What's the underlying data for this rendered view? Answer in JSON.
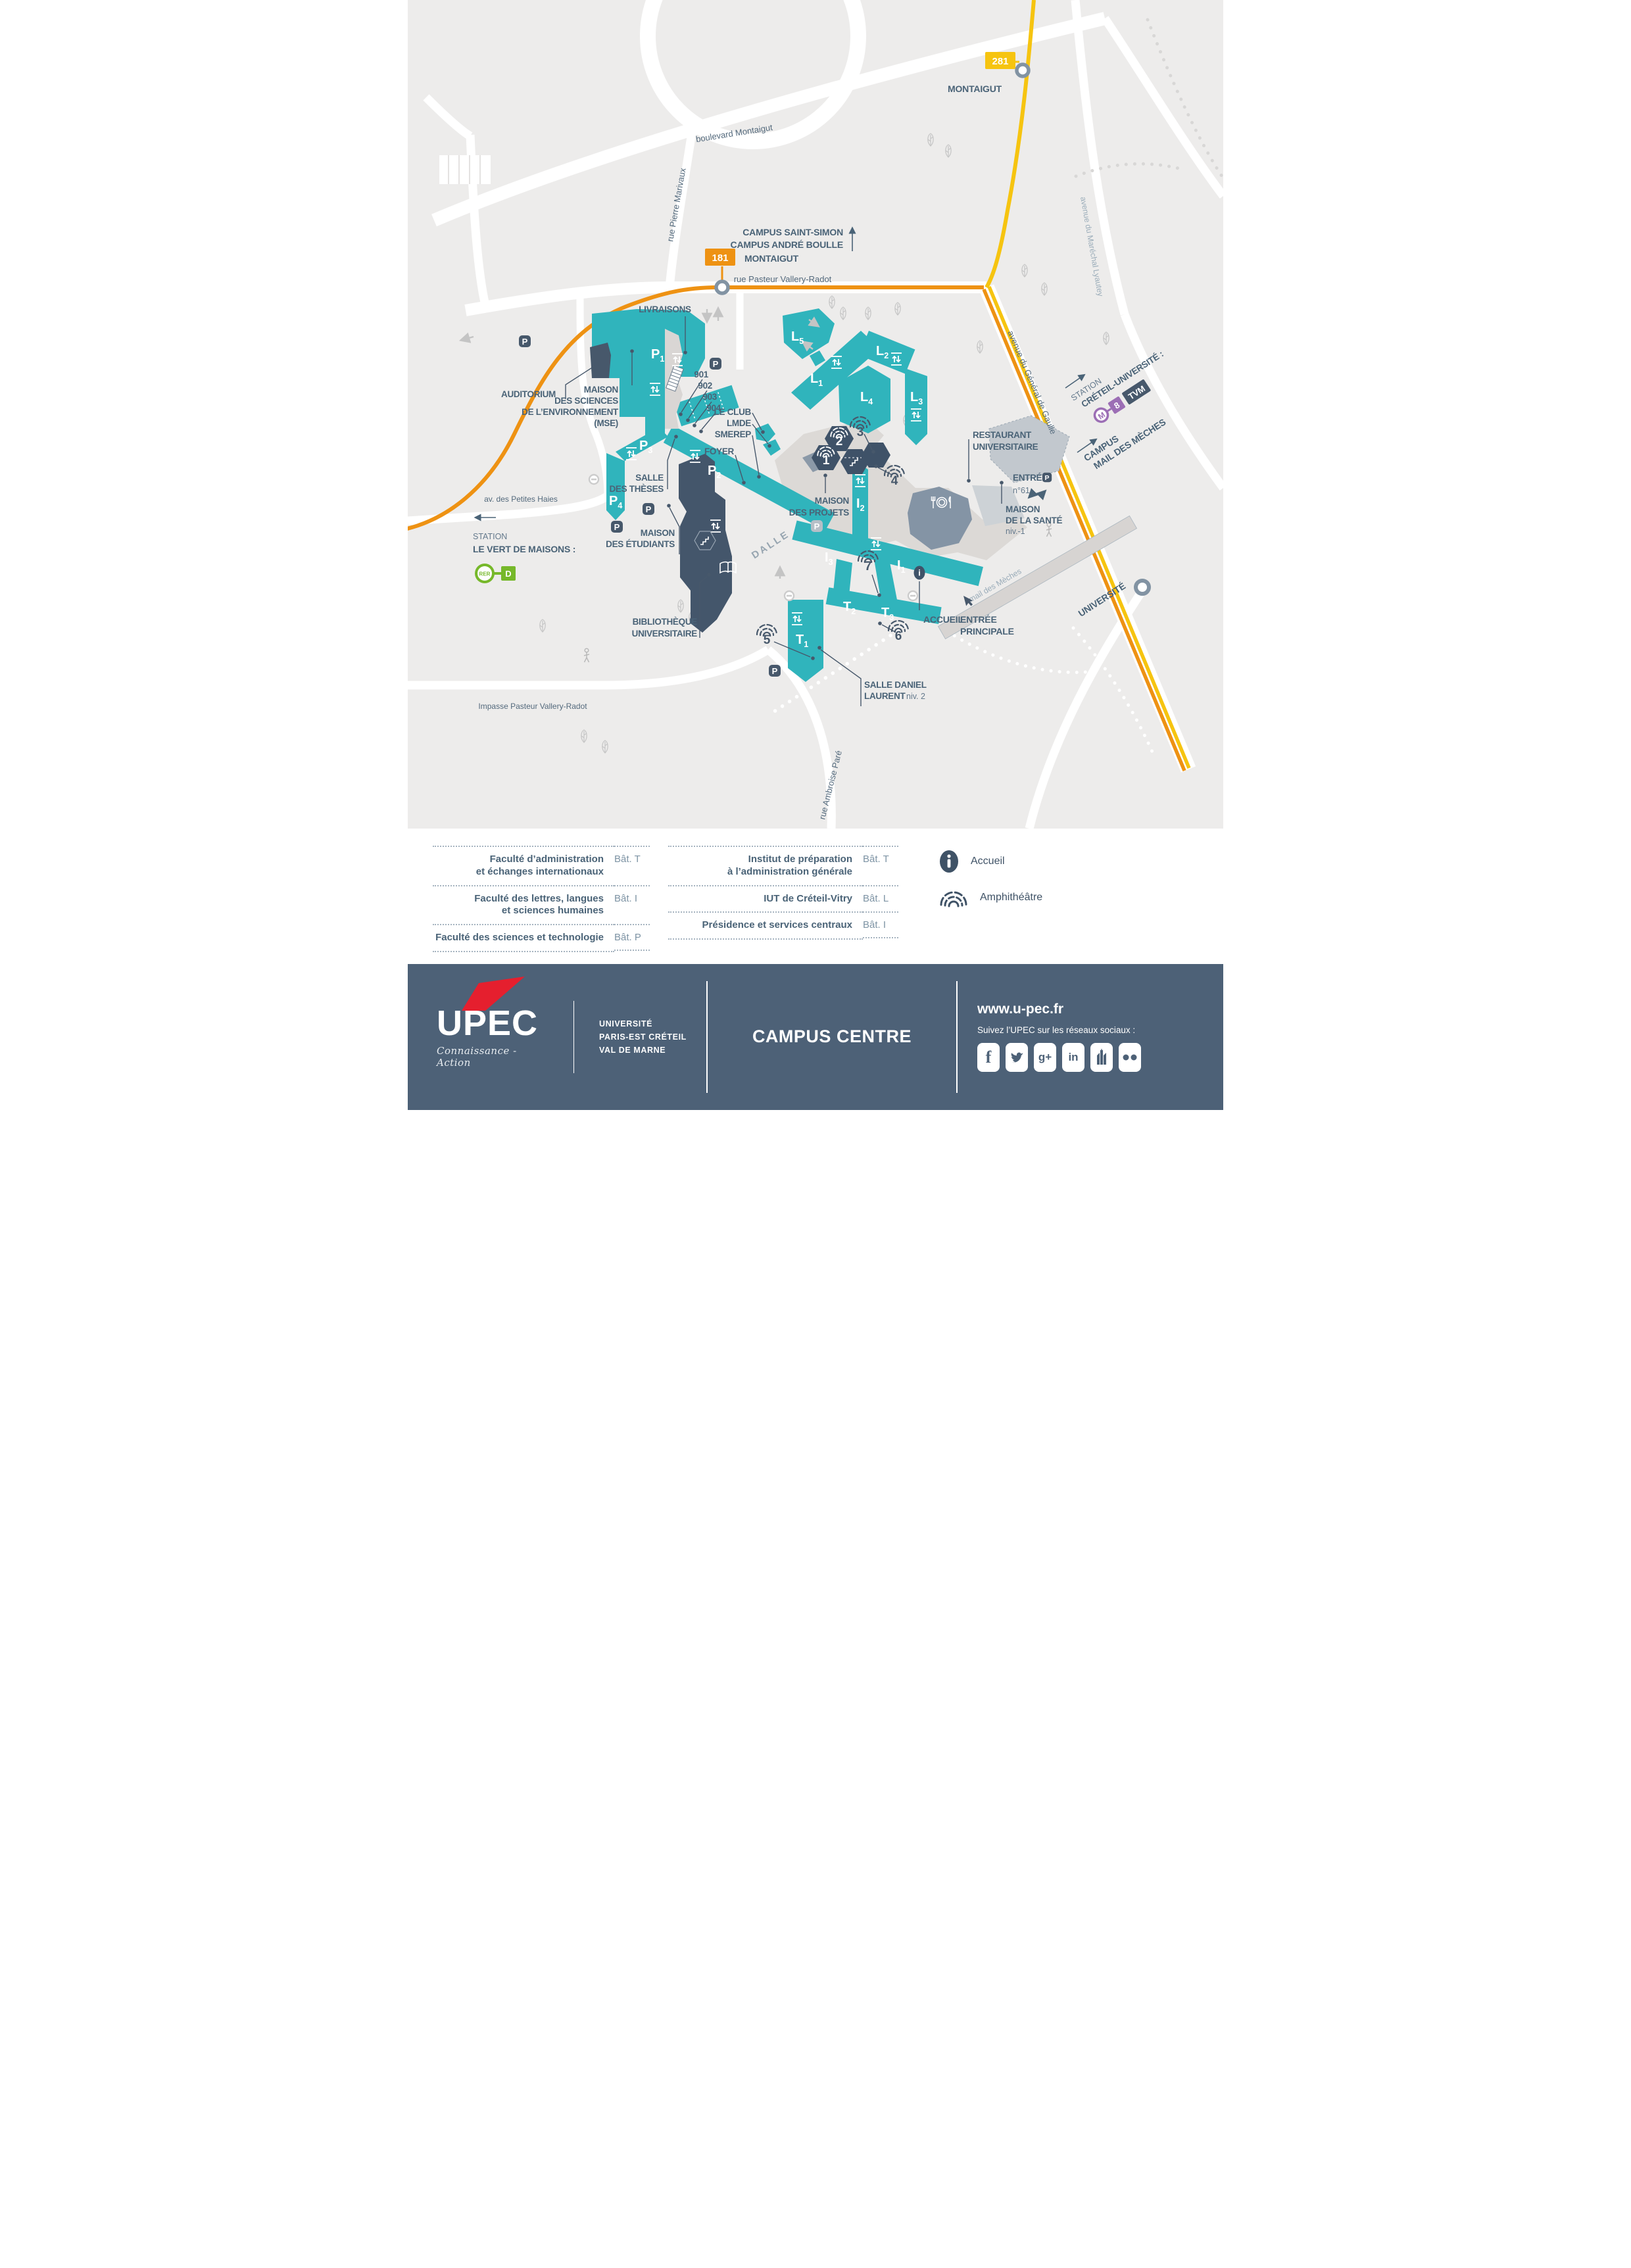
{
  "icons": {
    "parking": "P",
    "info": "i",
    "metro": "M",
    "metro_line": "8",
    "tvm": "TVM",
    "rer": "RER",
    "rer_line": "D"
  },
  "bus": {
    "line_281": "281",
    "line_181": "181",
    "montaigut": "MONTAIGUT",
    "universite": "UNIVERSITÉ"
  },
  "streets": {
    "boulevard_montaigut": "boulevard Montaigut",
    "rue_pierre_marivaux": "rue Pierre Marivaux",
    "rue_pasteur": "rue Pasteur Vallery-Radot",
    "impasse_pasteur": "Impasse Pasteur Vallery-Radot",
    "av_petites_haies": "av. des Petites Haies",
    "av_lyautey": "avenue du Maréchal Lyautey",
    "av_gaulle": "avenue du Général de Gaulle",
    "rue_ambroise_pare": "rue Ambroise Paré",
    "mail_des_meches": "mail des Mèches",
    "dalle": "DALLE"
  },
  "wayfinding": {
    "campus_saint_simon": "CAMPUS SAINT-SIMON",
    "campus_andre_boulle": "CAMPUS ANDRÉ BOULLE",
    "station": "STATION",
    "creteil_universite": "CRÉTEIL-UNIVERSITÉ :",
    "campus": "CAMPUS",
    "mail_des_meches": "MAIL DES MÈCHES",
    "le_vert_de_maisons": "LE VERT DE MAISONS :",
    "entree": "ENTRÉE",
    "n61": "n°61",
    "accueil": "ACCUEIL",
    "entree_principale_1": "ENTRÉE",
    "entree_principale_2": "PRINCIPALE"
  },
  "places": {
    "livraisons": "LIVRAISONS",
    "auditorium": "AUDITORIUM",
    "mse_1": "MAISON",
    "mse_2": "DES SCIENCES",
    "mse_3": "DE L’ENVIRONNEMENT",
    "mse_4": "(MSE)",
    "le_club": "LE CLUB",
    "lmde": "LMDE",
    "smerep": "SMEREP",
    "foyer": "FOYER",
    "salle_theses_1": "SALLE",
    "salle_theses_2": "DES THÈSES",
    "maison_etudiants_1": "MAISON",
    "maison_etudiants_2": "DES ÉTUDIANTS",
    "maison_projets_1": "MAISON",
    "maison_projets_2": "DES PROJETS",
    "restaurant_1": "RESTAURANT",
    "restaurant_2": "UNIVERSITAIRE",
    "maison_sante_1": "MAISON",
    "maison_sante_2": "DE LA SANTÉ",
    "maison_sante_niv": "niv.-1",
    "bibliotheque_1": "BIBLIOTHÈQUE",
    "bibliotheque_2": "UNIVERSITAIRE",
    "salle_daniel_1": "SALLE DANIEL",
    "salle_daniel_2": "LAURENT",
    "salle_daniel_niv": "niv. 2",
    "r901": "901",
    "r902": "902",
    "r903": "903",
    "r904": "904"
  },
  "buildings": {
    "p1": {
      "b": "P",
      "s": "1"
    },
    "p2": {
      "b": "P",
      "s": "2"
    },
    "p3": {
      "b": "P",
      "s": "3"
    },
    "p4": {
      "b": "P",
      "s": "4"
    },
    "l1": {
      "b": "L",
      "s": "1"
    },
    "l2": {
      "b": "L",
      "s": "2"
    },
    "l3": {
      "b": "L",
      "s": "3"
    },
    "l4": {
      "b": "L",
      "s": "4"
    },
    "l5": {
      "b": "L",
      "s": "5"
    },
    "i1": {
      "b": "I",
      "s": "1"
    },
    "i2": {
      "b": "I",
      "s": "2"
    },
    "i3": {
      "b": "I",
      "s": "3"
    },
    "t1": {
      "b": "T",
      "s": "1"
    },
    "t2": {
      "b": "T",
      "s": "2"
    },
    "t3": {
      "b": "T",
      "s": "3"
    }
  },
  "amphis": {
    "a1": "1",
    "a2": "2",
    "a3": "3",
    "a4": "4",
    "a5": "5",
    "a6": "6",
    "a7": "7"
  },
  "legend": {
    "a1_1": "Faculté d’administration",
    "a1_2": "et échanges internationaux",
    "a1_bat": "Bât. T",
    "a2_1": "Faculté des lettres, langues",
    "a2_2": "et sciences humaines",
    "a2_bat": "Bât. I",
    "a3_1": "Faculté des sciences et technologie",
    "a3_bat": "Bât. P",
    "b1_1": "Institut de préparation",
    "b1_2": "à l’administration générale",
    "b1_bat": "Bât. T",
    "b2_1": "IUT de Créteil-Vitry",
    "b2_bat": "Bât. L",
    "b3_1": "Présidence et services centraux",
    "b3_bat": "Bât. I",
    "accueil": "Accueil",
    "amphitheatre": "Amphithéâtre"
  },
  "footer": {
    "upec": "UPEC",
    "tagline": "Connaissance - Action",
    "uni1": "UNIVERSITÉ",
    "uni2": "PARIS-EST CRÉTEIL",
    "uni3": "VAL DE MARNE",
    "campus": "CAMPUS CENTRE",
    "url": "www.u-pec.fr",
    "follow": "Suivez l’UPEC sur les réseaux sociaux :"
  }
}
